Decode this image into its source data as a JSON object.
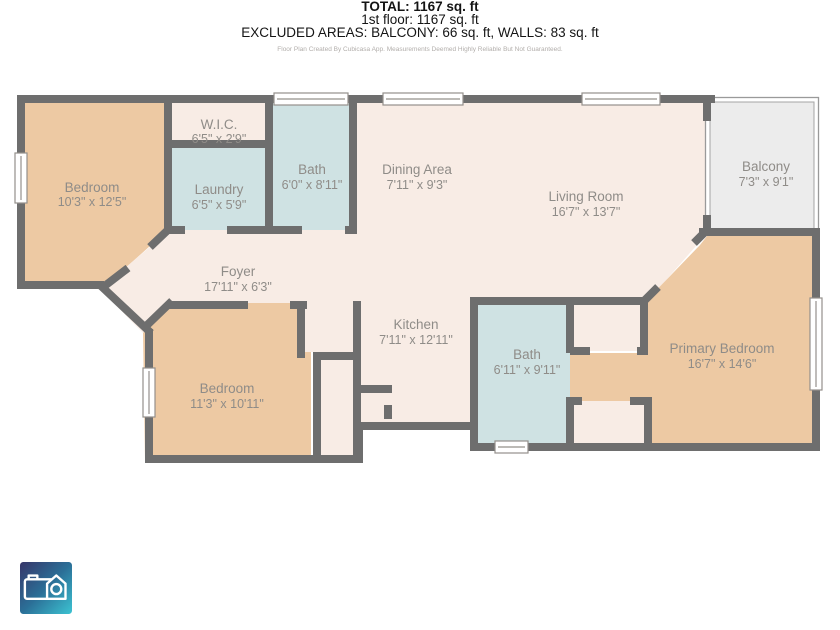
{
  "plan": {
    "rooms": [
      {
        "name": "Bedroom",
        "dims": "10'3\" x 12'5\""
      },
      {
        "name": "W.I.C.",
        "dims": "6'5\" x 2'9\""
      },
      {
        "name": "Laundry",
        "dims": "6'5\" x 5'9\""
      },
      {
        "name": "Bath",
        "dims": "6'0\" x 8'11\""
      },
      {
        "name": "Dining Area",
        "dims": "7'11\" x 9'3\""
      },
      {
        "name": "Living Room",
        "dims": "16'7\" x 13'7\""
      },
      {
        "name": "Balcony",
        "dims": "7'3\" x 9'1\""
      },
      {
        "name": "Foyer",
        "dims": "17'11\" x 6'3\""
      },
      {
        "name": "Kitchen",
        "dims": "7'11\" x 12'11\""
      },
      {
        "name": "Bath",
        "dims": "6'11\" x 9'11\""
      },
      {
        "name": "Primary Bedroom",
        "dims": "16'7\" x 14'6\""
      },
      {
        "name": "Bedroom",
        "dims": "11'3\" x 10'11\""
      }
    ],
    "colors": {
      "wall": "#6e6e6e",
      "bedroom_fill": "#edc9a3",
      "bath_fill": "#cfe2e3",
      "common_fill": "#f8ece5",
      "balcony_fill": "#ececec",
      "label_text": "#8f8c88",
      "logo_gradient_start": "#373569",
      "logo_gradient_end": "#3cc3d2"
    }
  },
  "summary": {
    "total": "TOTAL: 1167 sq. ft",
    "floor": "1st floor: 1167 sq. ft",
    "excluded": "EXCLUDED AREAS: BALCONY: 66 sq. ft, WALLS: 83 sq. ft",
    "disclaimer": "Floor Plan Created By Cubicasa App. Measurements Deemed Highly Reliable But Not Guaranteed."
  }
}
